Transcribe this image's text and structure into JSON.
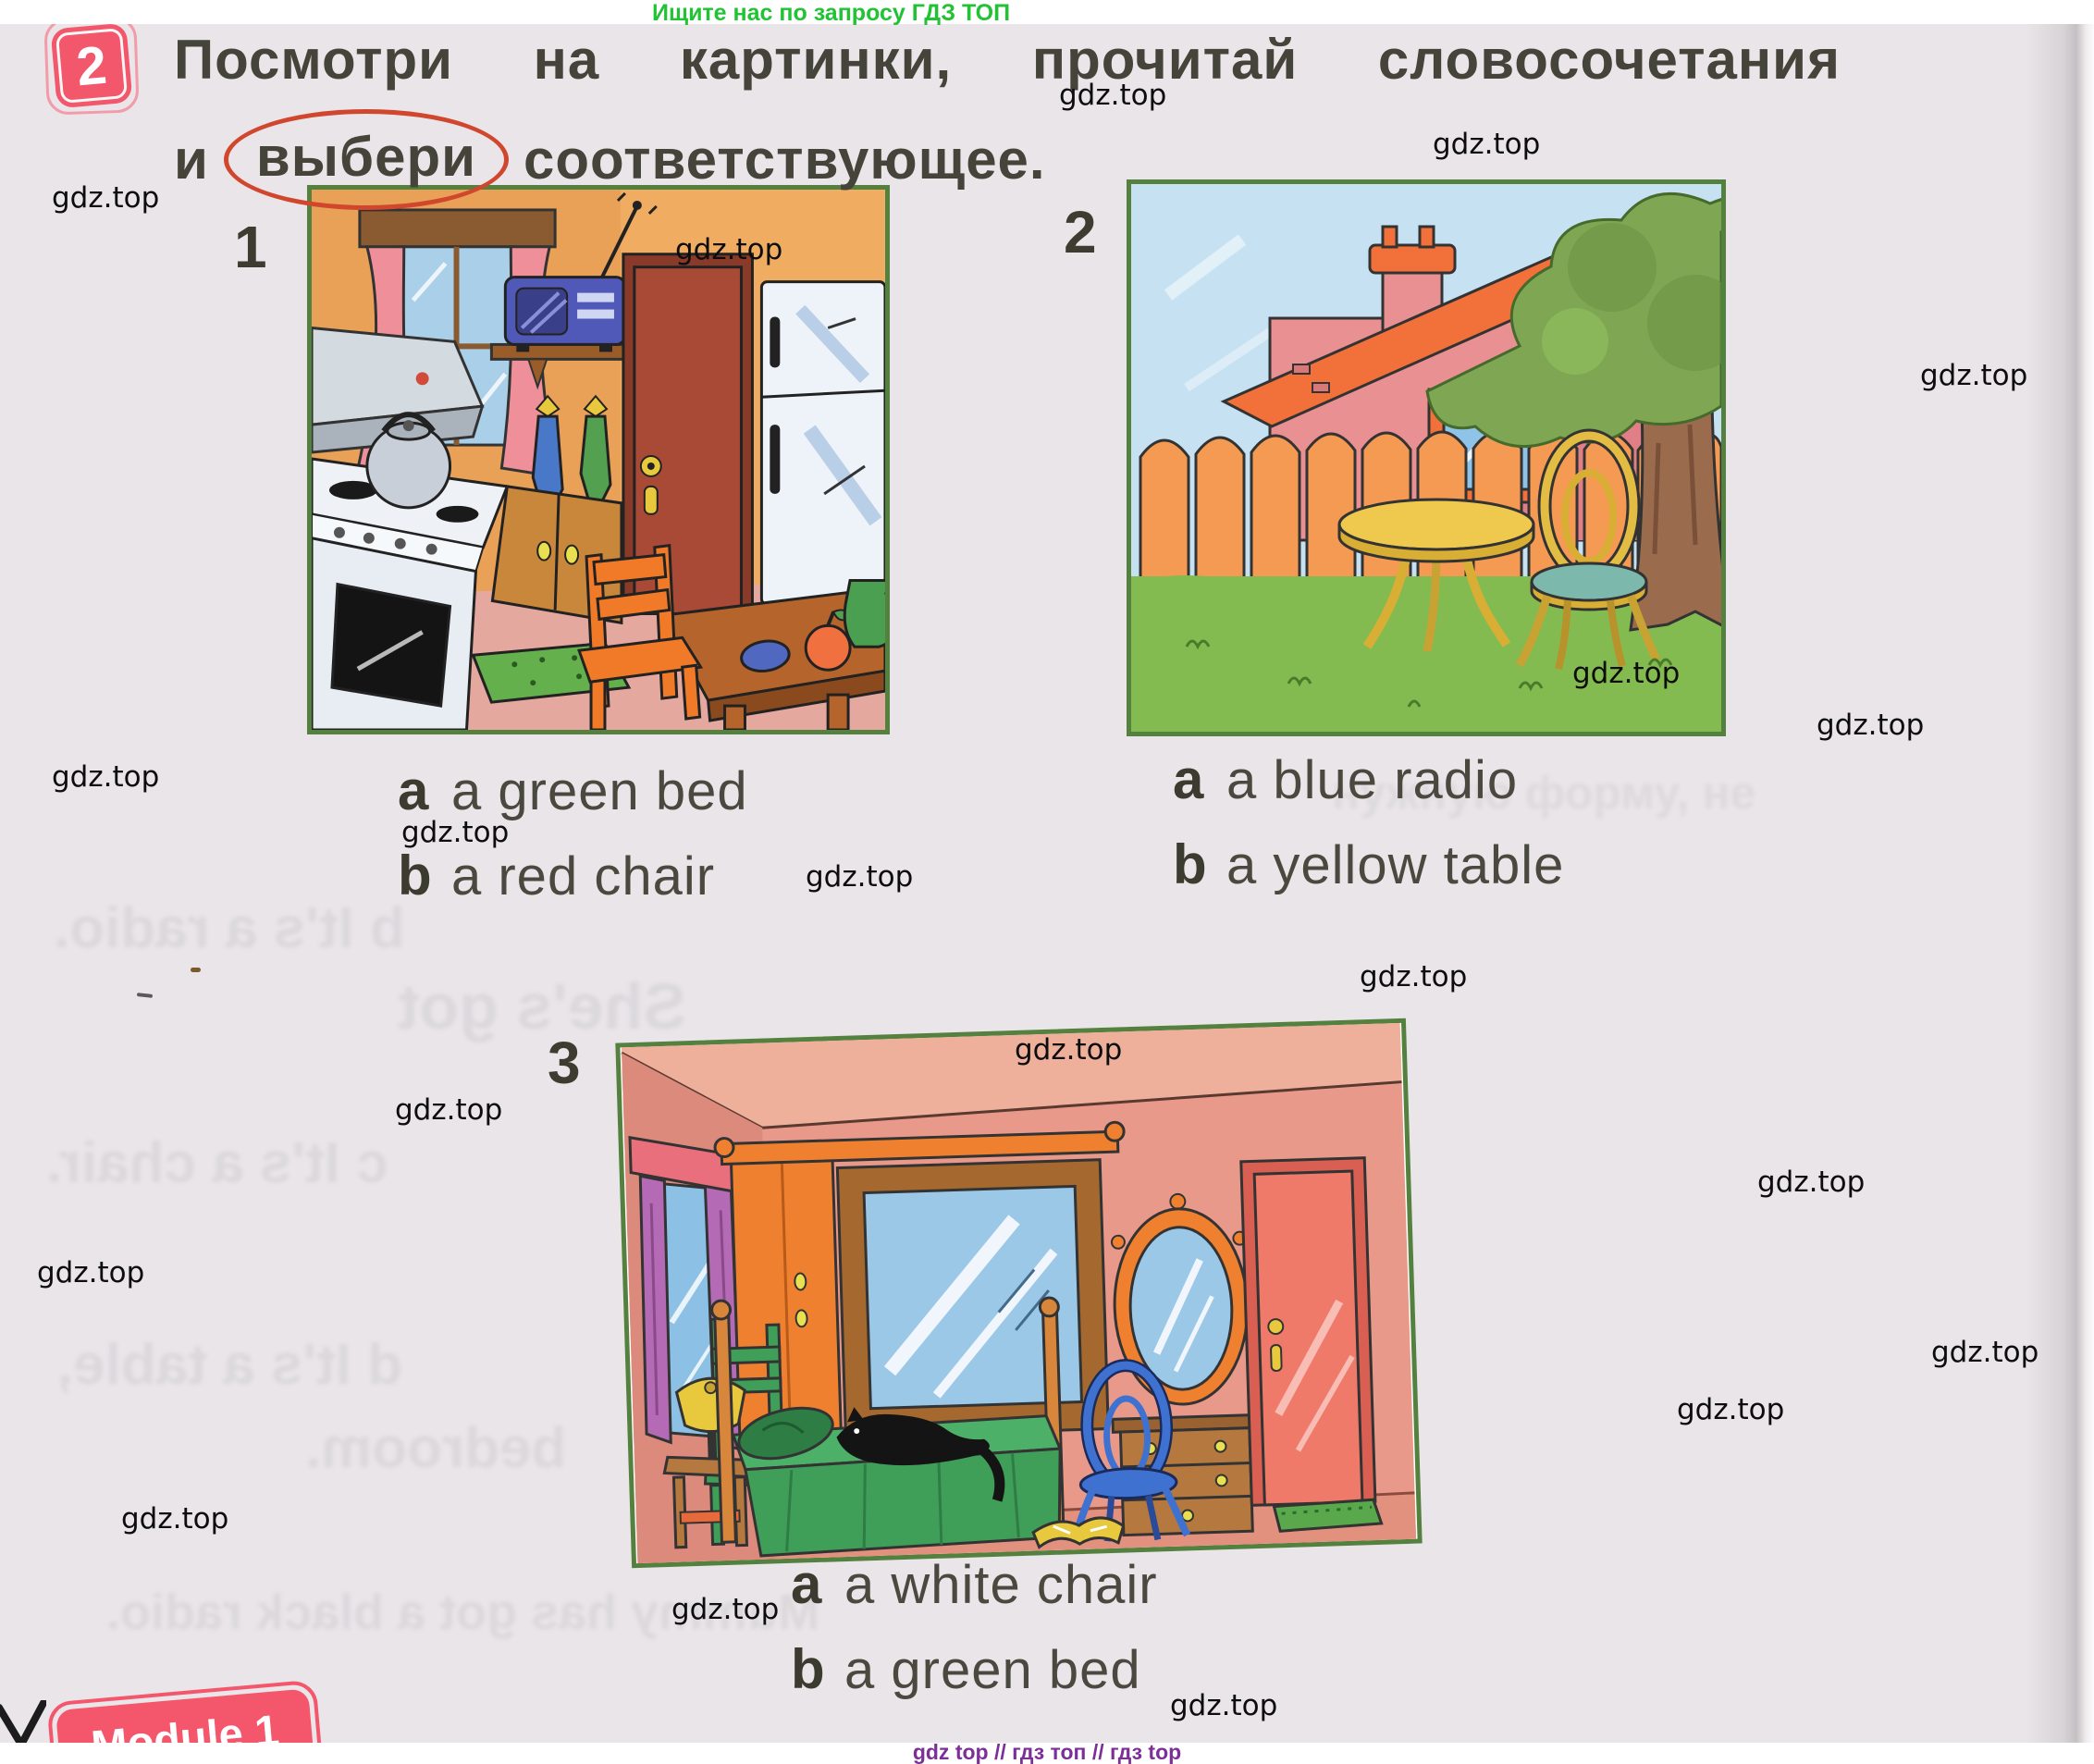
{
  "top_banner": {
    "text": "Ищите нас по запросу ГДЗ ТОП"
  },
  "bottom_banner": {
    "text": "gdz top // гдз топ // гдз top"
  },
  "watermark": {
    "text": "gdz.top"
  },
  "exercise": {
    "number": "2",
    "instruction_line1": "Посмотри на картинки, прочитай словосочетания",
    "instruction_line2_prefix": "и",
    "instruction_circled_word": "выбери",
    "instruction_line2_suffix": "соответствующее."
  },
  "items": [
    {
      "label": "1",
      "scene": "kitchen",
      "options": [
        {
          "letter": "a",
          "text": "a green bed"
        },
        {
          "letter": "b",
          "text": "a red chair"
        }
      ]
    },
    {
      "label": "2",
      "scene": "garden",
      "options": [
        {
          "letter": "a",
          "text": "a blue radio"
        },
        {
          "letter": "b",
          "text": "a yellow table"
        }
      ]
    },
    {
      "label": "3",
      "scene": "bedroom",
      "options": [
        {
          "letter": "a",
          "text": "a white chair"
        },
        {
          "letter": "b",
          "text": "a green bed"
        }
      ]
    }
  ],
  "module_banner": {
    "text": "Module 1"
  },
  "ghost_lines": [
    "b It's a radio.",
    "She's got",
    "c It's a chair.",
    "d It's a table,",
    "bedroom.",
    "Mummy has got a black radio.",
    "нужную форму, не"
  ],
  "colors": {
    "badge": "#f3576c",
    "circle": "#d0472e",
    "picture_border": "#54813f",
    "top_banner_green": "#22c235",
    "bottom_banner_purple": "#7b2f97"
  }
}
